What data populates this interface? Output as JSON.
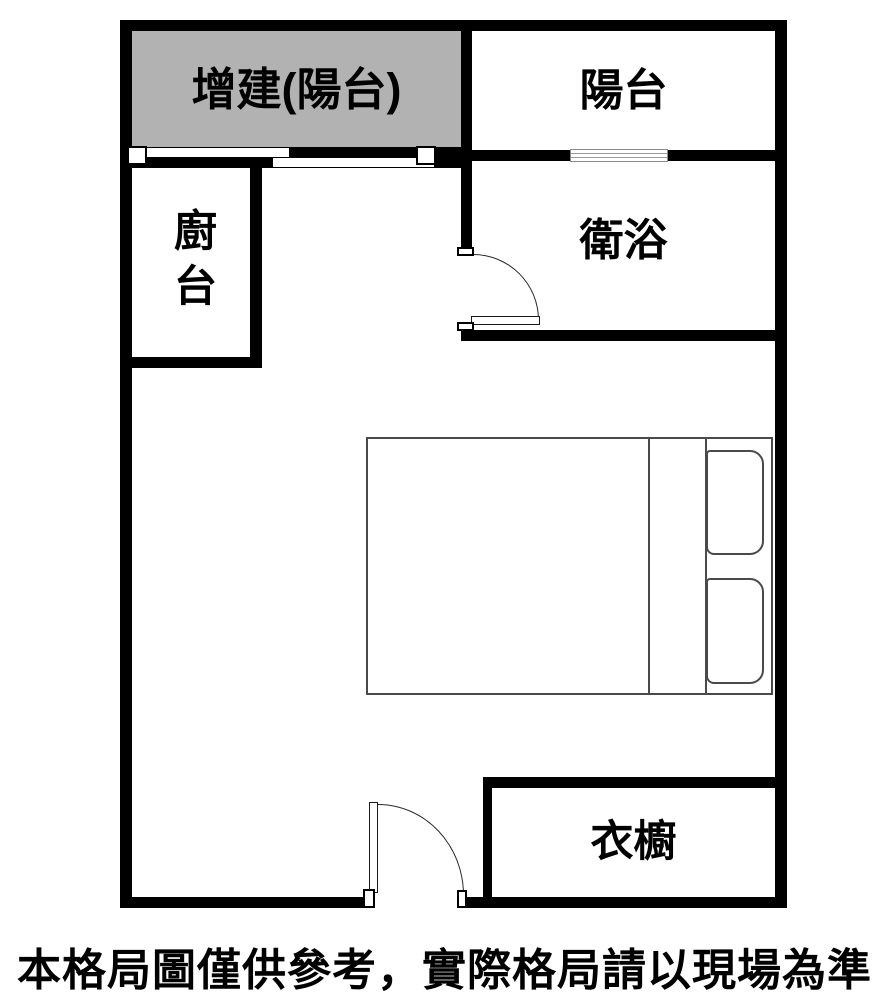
{
  "title": "apartment-floor-plan",
  "rooms": {
    "added_balcony": {
      "label": "增建(陽台)"
    },
    "balcony": {
      "label": "陽台"
    },
    "bathroom": {
      "label": "衛浴"
    },
    "kitchen": {
      "label": "廚台"
    },
    "wardrobe": {
      "label": "衣櫥"
    }
  },
  "furniture": {
    "bed": {
      "name": "double-bed",
      "pillows": 2
    }
  },
  "symbols": {
    "added_balcony_opening": "sliding-door",
    "balcony_window": "window",
    "bathroom_door": "swing-door",
    "entry_door": "swing-door"
  },
  "disclaimer": "本格局圖僅供參考，實際格局請以現場為準",
  "colors": {
    "wall": "#000000",
    "added_area_fill": "#b2b2b2",
    "furniture_line": "#4a4a4a",
    "background": "#ffffff",
    "text": "#000000"
  }
}
